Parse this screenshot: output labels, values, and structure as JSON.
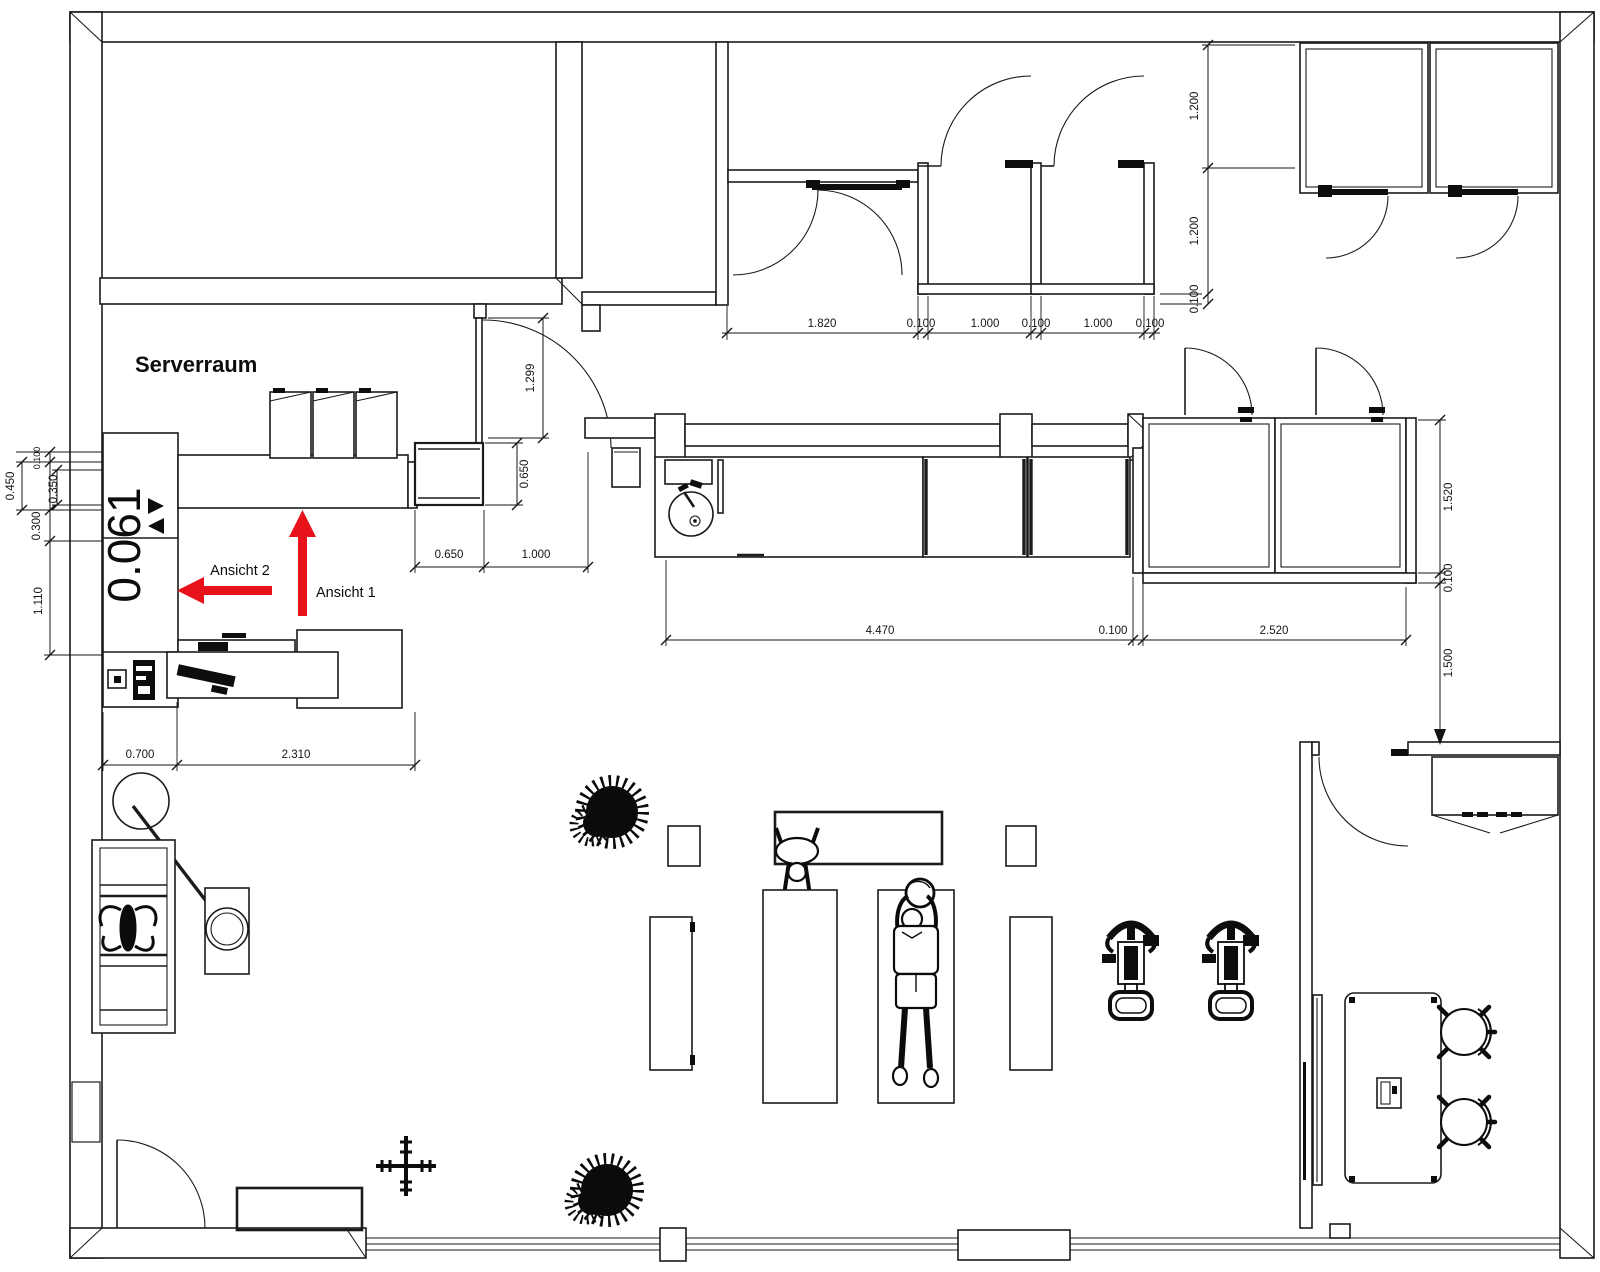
{
  "plan": {
    "room_label": "Serverraum",
    "level_code": "0.061",
    "view_arrow_1": "Ansicht 1",
    "view_arrow_2": "Ansicht 2"
  },
  "colors": {
    "line": "#1b1b1b",
    "dimension_text": "#141414",
    "accent_red": "#e8131a",
    "background": "#ffffff"
  },
  "dimensions": [
    {
      "t": "1.820",
      "x": 822,
      "y": 327,
      "r": 0
    },
    {
      "t": "0.100",
      "x": 921,
      "y": 327,
      "r": 0
    },
    {
      "t": "1.000",
      "x": 985,
      "y": 327,
      "r": 0
    },
    {
      "t": "0.100",
      "x": 1036,
      "y": 327,
      "r": 0
    },
    {
      "t": "1.000",
      "x": 1098,
      "y": 327,
      "r": 0
    },
    {
      "t": "0.100",
      "x": 1150,
      "y": 327,
      "r": 0
    },
    {
      "t": "1.200",
      "x": 1198,
      "y": 106,
      "r": 1
    },
    {
      "t": "1.200",
      "x": 1198,
      "y": 231,
      "r": 1
    },
    {
      "t": "0.100",
      "x": 1198,
      "y": 299,
      "r": 1
    },
    {
      "t": "1.299",
      "x": 534,
      "y": 378,
      "r": 1
    },
    {
      "t": "0.650",
      "x": 528,
      "y": 474,
      "r": 1
    },
    {
      "t": "0.650",
      "x": 449,
      "y": 558,
      "r": 0
    },
    {
      "t": "1.000",
      "x": 536,
      "y": 558,
      "r": 0
    },
    {
      "t": "4.470",
      "x": 880,
      "y": 634,
      "r": 0
    },
    {
      "t": "0.100",
      "x": 1113,
      "y": 634,
      "r": 0
    },
    {
      "t": "2.520",
      "x": 1274,
      "y": 634,
      "r": 0
    },
    {
      "t": "1.520",
      "x": 1452,
      "y": 497,
      "r": 1
    },
    {
      "t": "0.100",
      "x": 1452,
      "y": 578,
      "r": 1
    },
    {
      "t": "1.500",
      "x": 1452,
      "y": 663,
      "r": 1
    },
    {
      "t": "0.450",
      "x": 14,
      "y": 486,
      "r": 1
    },
    {
      "t": "0.100",
      "x": 40,
      "y": 458,
      "r": 1,
      "s": 1
    },
    {
      "t": "0.350",
      "x": 57,
      "y": 489,
      "r": 1
    },
    {
      "t": "0.300",
      "x": 40,
      "y": 526,
      "r": 1
    },
    {
      "t": "1.110",
      "x": 42,
      "y": 601,
      "r": 1
    },
    {
      "t": "0.700",
      "x": 140,
      "y": 758,
      "r": 0
    },
    {
      "t": "2.310",
      "x": 296,
      "y": 758,
      "r": 0
    }
  ]
}
